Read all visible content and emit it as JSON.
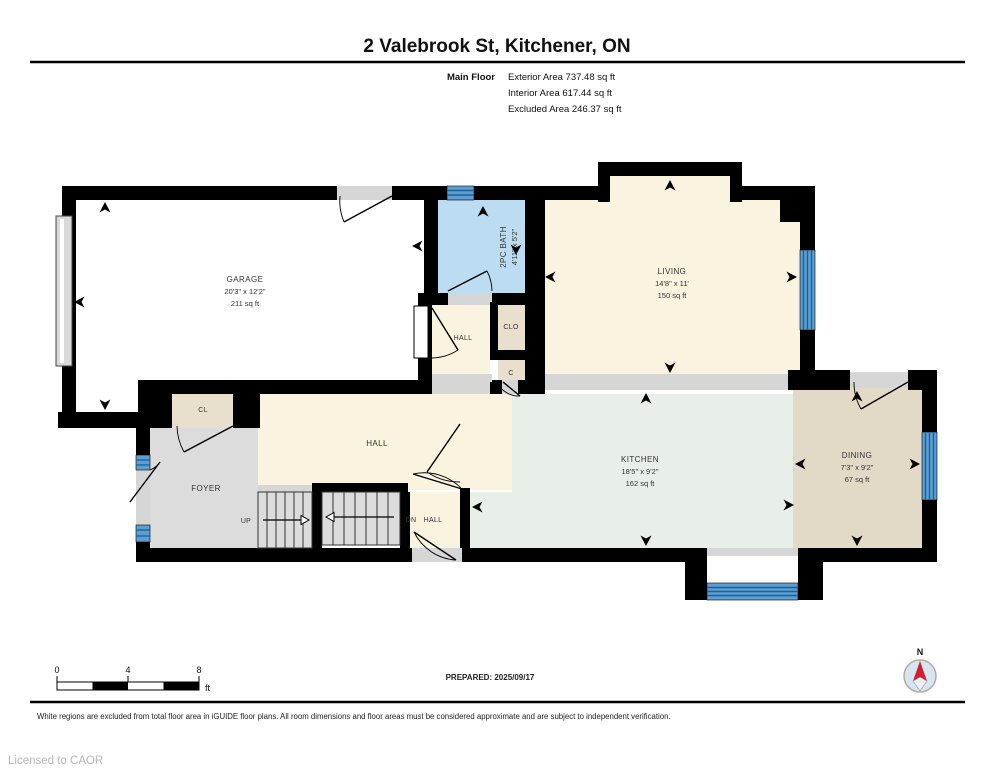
{
  "header": {
    "title": "2 Valebrook St, Kitchener, ON",
    "floor_label": "Main Floor",
    "stats": [
      "Exterior Area 737.48 sq ft",
      "Interior Area 617.44 sq ft",
      "Excluded Area 246.37 sq ft"
    ]
  },
  "rooms": {
    "garage": {
      "name": "GARAGE",
      "dims": "20'3\" x 12'2\"",
      "area": "211 sq ft"
    },
    "bath": {
      "name": "2PC BATH",
      "dims": "4'11\" x 5'2\""
    },
    "living": {
      "name": "LIVING",
      "dims": "14'8\" x 11'",
      "area": "150 sq ft"
    },
    "kitchen": {
      "name": "KITCHEN",
      "dims": "18'5\" x 9'2\"",
      "area": "162 sq ft"
    },
    "dining": {
      "name": "DINING",
      "dims": "7'3\" x 9'2\"",
      "area": "67 sq ft"
    },
    "hall_main": {
      "name": "HALL"
    },
    "hall_upper": {
      "name": "HALL"
    },
    "hall_lower": {
      "name": "HALL"
    },
    "foyer": {
      "name": "FOYER"
    },
    "closet_cl": {
      "name": "CL"
    },
    "closet_clo": {
      "name": "CLO"
    },
    "closet_c": {
      "name": "C"
    }
  },
  "stairs": {
    "up": "UP",
    "dn": "DN"
  },
  "footer": {
    "scale": {
      "ticks": [
        "0",
        "4",
        "8"
      ],
      "unit": "ft"
    },
    "prepared": "PREPARED: 2025/09/17",
    "compass_north": "N",
    "disclaimer": "White regions are excluded from total floor area in iGUIDE floor plans. All room dimensions and floor areas must be considered approximate and are subject to independent verification.",
    "license": "Licensed to CAOR"
  },
  "colors": {
    "wall": "#000000",
    "window_glass": "#5c9fd3",
    "window_stripe": "#1d5f96",
    "bath_fill": "#bcdcf2",
    "cream_fill": "#faf3e0",
    "kitchen_fill": "#e7efe8",
    "dining_fill": "#e3d9c7",
    "closet_fill": "#e9dfcd",
    "foyer_fill": "#dcdcdc",
    "stairs_fill": "#dcdcdc",
    "excluded_fill": "#ffffff",
    "compass_north_color": "#cf2030"
  }
}
